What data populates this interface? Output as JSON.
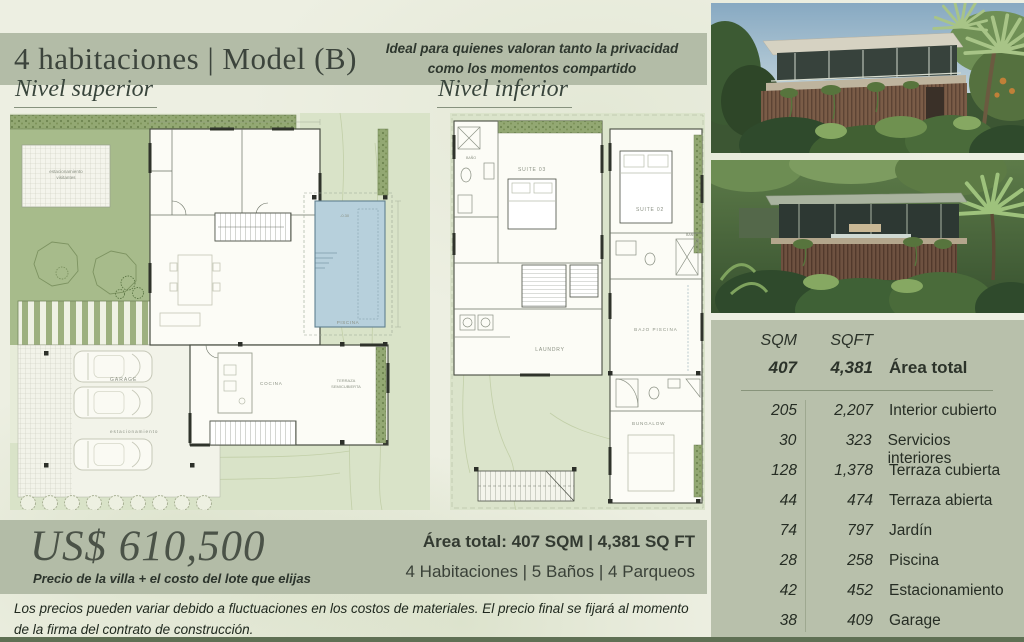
{
  "header": {
    "title": "4 habitaciones | Model (B)",
    "tagline_line1": "Ideal para quienes valoran tanto la privacidad",
    "tagline_line2": "como los momentos compartido"
  },
  "sections": {
    "upper": "Nivel superior",
    "lower": "Nivel inferior"
  },
  "plan_labels": {
    "upper": {
      "visitor_parking_1": "estacionamiento",
      "visitor_parking_2": "visitantes",
      "garage": "GARAGE",
      "parking": "estacionamiento",
      "kitchen": "COCINA",
      "pool": "PISCINA",
      "pool_level": "-0.30",
      "terrace_1": "TERRAZA",
      "terrace_2": "SEMICUBIERTA"
    },
    "lower": {
      "suite03": "SUITE 03",
      "bath1": "BAÑO",
      "laundry": "LAUNDRY",
      "suite02": "SUITE 02",
      "bath2": "BAÑO",
      "under_pool": "BAJO PISCINA",
      "bungalow": "BUNGALOW"
    }
  },
  "price": {
    "amount": "US$ 610,500",
    "note": "Precio de la villa + el costo del lote que elijas"
  },
  "summary": {
    "area_line": "Área total: 407 SQM | 4,381 SQ FT",
    "features_line": "4 Habitaciones | 5 Baños | 4 Parqueos"
  },
  "disclaimer": "Los precios pueden variar debido a fluctuaciones en los costos de materiales. El precio final se fijará al momento de la firma del contrato de construcción.",
  "area_table": {
    "headers": {
      "sqm": "SQM",
      "sqft": "SQFT"
    },
    "total": {
      "sqm": "407",
      "sqft": "4,381",
      "label": "Área total"
    },
    "rows": [
      {
        "sqm": "205",
        "sqft": "2,207",
        "label": "Interior cubierto"
      },
      {
        "sqm": "30",
        "sqft": "323",
        "label": "Servicios interiores"
      },
      {
        "sqm": "128",
        "sqft": "1,378",
        "label": "Terraza cubierta"
      },
      {
        "sqm": "44",
        "sqft": "474",
        "label": "Terraza abierta"
      },
      {
        "sqm": "74",
        "sqft": "797",
        "label": "Jardín"
      },
      {
        "sqm": "28",
        "sqft": "258",
        "label": "Piscina"
      },
      {
        "sqm": "42",
        "sqft": "452",
        "label": "Estacionamiento"
      },
      {
        "sqm": "38",
        "sqft": "409",
        "label": "Garage"
      }
    ]
  },
  "colors": {
    "band": "#b3bca7",
    "table_bg": "#b8c0ab",
    "garden": "#a7bb8b",
    "terrain": "#d9e3c8",
    "pool": "#b7d0dc",
    "ink": "#2c332a",
    "bottom_bar": "#5f7054"
  }
}
